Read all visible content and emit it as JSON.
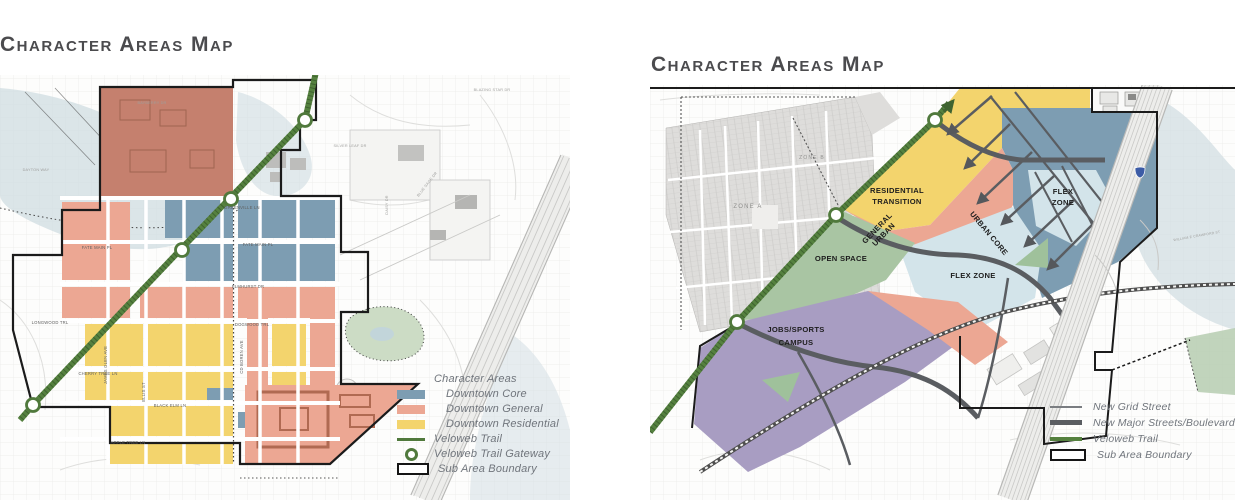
{
  "left_map": {
    "title": "Character Areas Map",
    "legend": {
      "header": "Character Areas",
      "items": [
        {
          "label": "Downtown Core",
          "color": "#7d9db2",
          "type": "swatch"
        },
        {
          "label": "Downtown General",
          "color": "#eca793",
          "type": "swatch"
        },
        {
          "label": "Downtown Residential",
          "color": "#f3d46d",
          "type": "swatch"
        },
        {
          "label": "Veloweb Trail",
          "color": "#50793c",
          "type": "line"
        },
        {
          "label": "Veloweb Trail Gateway",
          "color": "#50793c",
          "type": "circle"
        },
        {
          "label": "Sub Area Boundary",
          "color": "#1b1b1b",
          "type": "boundary"
        }
      ]
    },
    "streets": {
      "greenville_ln": "GREENVILLE LN",
      "fate_main_pl": "FATE MAIN PL",
      "fate_main_pl_w": "FATE MAIN PL",
      "elmhurst_dr": "ELMHURST DR",
      "dogwood_trl": "DOGWOOD TRL",
      "longwood_trl": "LONGWOOD TRL",
      "cherry_tree_ln": "CHERRY TREE LN",
      "black_elm_ln": "BLACK ELM LN",
      "apple_tree_ln": "APPLE TREE LN",
      "james_glen_ave": "JAMES GLEN AVE",
      "ellis_st": "ELLIS ST",
      "cd_boren_ave": "CD BOREN AVE"
    },
    "background_streets": {
      "dayton_way": "DAYTON WAY",
      "bayberry_dr": "BAYBERRY DR",
      "blazing_star_dr": "BLAZING STAR DR",
      "blue_sage_dr": "BLUE SAGE DR",
      "silver_leaf_dr": "SILVER LEAF DR",
      "daisy_dr": "DAISY DR"
    }
  },
  "right_map": {
    "title": "Character Areas Map",
    "zones": {
      "residential_transition_line1": "RESIDENTIAL",
      "residential_transition_line2": "TRANSITION",
      "general_urban_line1": "GENERAL",
      "general_urban_line2": "URBAN",
      "open_space": "OPEN SPACE",
      "urban_core": "URBAN CORE",
      "flex_zone_right_line1": "FLEX",
      "flex_zone_right_line2": "ZONE",
      "flex_zone_center": "FLEX ZONE",
      "jobs_sports_line1": "JOBS/SPORTS",
      "jobs_sports_line2": "CAMPUS",
      "zone_a": "ZONE A",
      "zone_b": "ZONE B"
    },
    "background_streets": {
      "we_crawford": "WILLIAM E CRAWFORD ST"
    },
    "legend": {
      "items": [
        {
          "label": "New Grid Street",
          "color": "#7a7d81",
          "type": "thin-line"
        },
        {
          "label": "New Major Streets/Boulevards",
          "color": "#5a5d61",
          "type": "thick-line"
        },
        {
          "label": "Veloweb Trail",
          "color": "#55813f",
          "type": "thick-line"
        },
        {
          "label": "Sub Area Boundary",
          "color": "#1b1b1b",
          "type": "boundary"
        }
      ]
    }
  },
  "colors": {
    "downtown_core_blue": "#7d9db2",
    "downtown_general_salmon": "#eca793",
    "downtown_residential_yellow": "#f3d46d",
    "veloweb_green": "#50793c",
    "flex_zone_light_blue": "#d3e4ea",
    "jobs_sports_purple": "#a89dc2",
    "open_space_green": "#a9c5a3",
    "existing_area_red": "#c5806e",
    "road_gray": "#5a5d61",
    "floodplain_blue_gray": "#cfdce1",
    "boundary_black": "#1b1b1b",
    "title_gray": "#4b4b4e"
  }
}
